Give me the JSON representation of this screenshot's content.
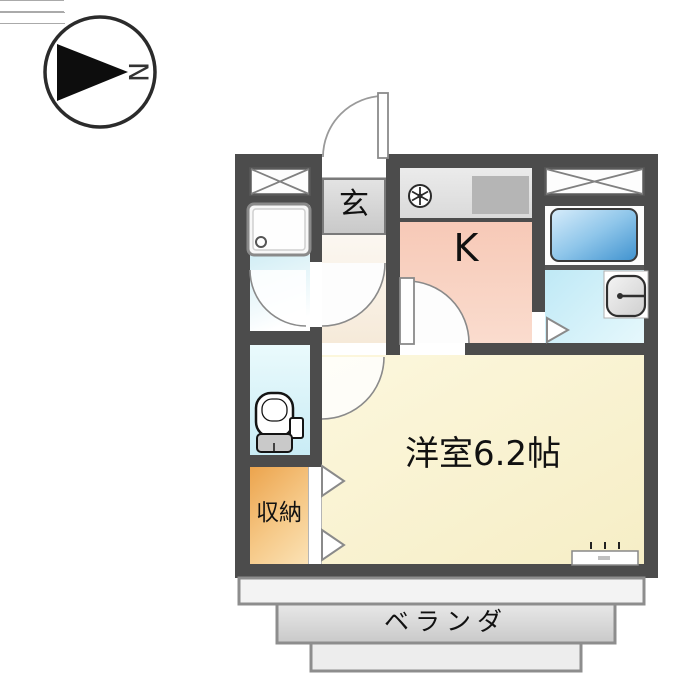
{
  "title": "apartment floor plan",
  "compass": {
    "label": "N"
  },
  "rooms": {
    "entrance": {
      "label": "玄"
    },
    "kitchen": {
      "label": "K"
    },
    "western_room": {
      "label": "洋室6.2帖"
    },
    "storage": {
      "label": "収納"
    },
    "veranda": {
      "label": "ベランダ"
    }
  },
  "fixtures": [
    "closet-x-left",
    "closet-x-right",
    "washing-machine-pan",
    "ventilation-fan",
    "stove",
    "bathtub",
    "washbasin",
    "toilet",
    "entrance-swing-door",
    "interior-swing-doors",
    "folding-doors",
    "window-to-veranda"
  ],
  "colors": {
    "wall": "#4c4c4c",
    "kitchen_fill": "#f7c9b7",
    "western_room_fill": "#f9f2d2",
    "storage_fill": "#eca44d",
    "bathroom_fill": "#bfe9f6",
    "toilet_fill": "#d5f1f7",
    "washroom_fill": "#d2eef5",
    "bathtub_fill": "#3f92cf",
    "genkan_fill": "#d6d6d6",
    "veranda_fill": "#d9d9d9"
  }
}
